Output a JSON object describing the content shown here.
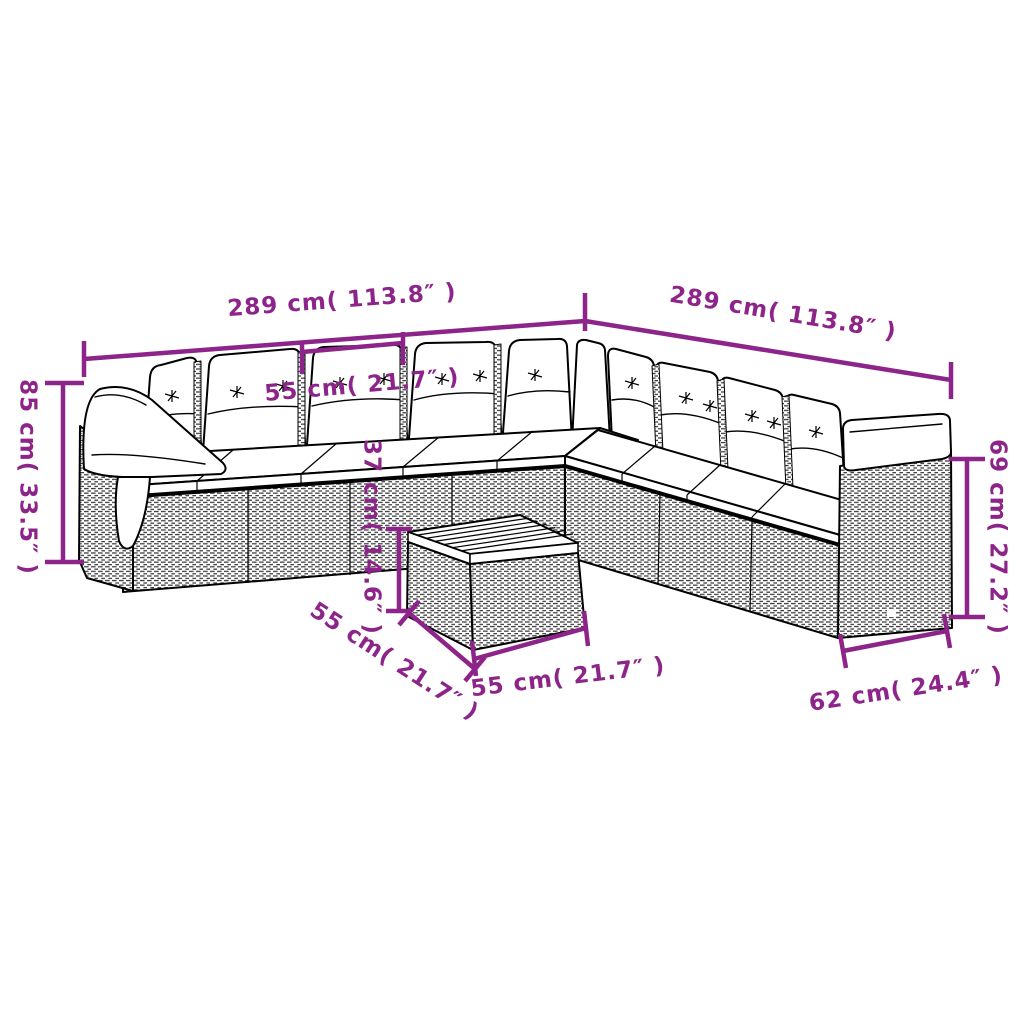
{
  "diagram": {
    "description": "dimension drawing of an L-shaped rattan garden sofa set with seat and back cushions and a square slatted coffee table",
    "background_color": "#ffffff",
    "dimension_color": "#8d2489",
    "outline_color": "#000000"
  },
  "labels": {
    "sofa_width_left": "289 cm( 113.8″ )",
    "sofa_width_right": "289 cm( 113.8″ )",
    "seat_module_width": "55 cm( 21.7″ )",
    "sofa_height_left": "85 cm( 33.5″ )",
    "sofa_height_right": "69 cm( 27.2″ )",
    "table_height": "37 cm( 14.6″ )",
    "table_depth": "55 cm( 21.7″ )",
    "table_width": "55 cm( 21.7″ )",
    "seat_module_depth": "62 cm( 24.4″ )"
  }
}
